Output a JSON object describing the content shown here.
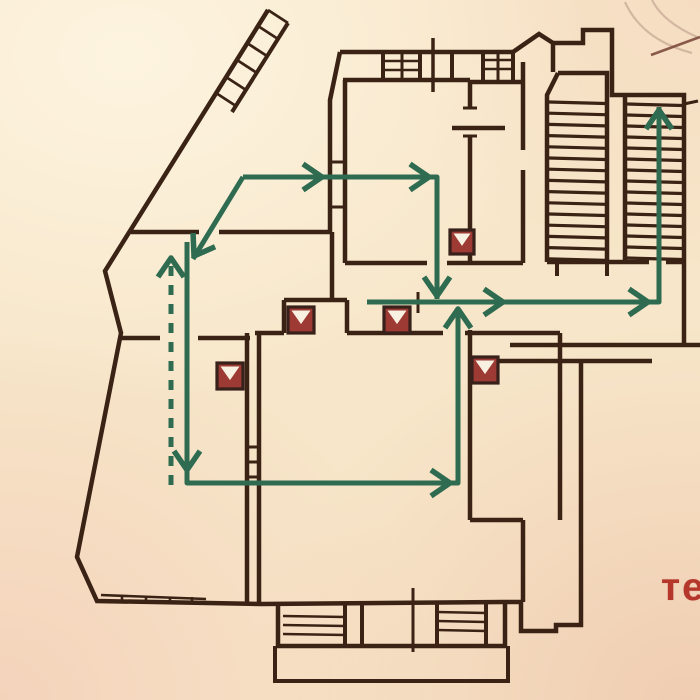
{
  "meta": {
    "description": "Photograph of a building evacuation floor plan with green escape-route arrows and red equipment markers",
    "background_paper": "#f7e6c9"
  },
  "palette": {
    "wall": "#3a2315",
    "route_green": "#2e6b50",
    "marker_fill": "#9d3a33",
    "marker_border": "#37211a",
    "marker_triangle": "#f8f0e0",
    "text_red": "#b5372c",
    "stamp": "#a98a76",
    "stamp_line": "#7d4a3c"
  },
  "annotations": {
    "partial_text": "те"
  },
  "building": {
    "walls": [
      {
        "d": "M268,10 L105,271 L121,333 L77,557 L97,601 L262,604 L503,602 L521,602 L521,631 L556,631 L556,625 L581,625 L581,362"
      },
      {
        "d": "M481,361 L652,361"
      },
      {
        "d": "M510,345 L700,345"
      },
      {
        "d": "M684,345 L684,262"
      },
      {
        "d": "M547,262 L649,262 M666,262 L684,262"
      },
      {
        "d": "M558,73 L607,73 L607,262 M558,73 L547,95 L547,262"
      },
      {
        "d": "M625,95 L684,95 L684,262 M625,95 L625,262"
      },
      {
        "d": "M553,72 L553,43 L583,43 L583,30 L612,30 L612,95 L625,95"
      },
      {
        "d": "M684,104 L698,101",
        "w": 3
      },
      {
        "d": "M340,52 L513,52 L539,34 L553,43"
      },
      {
        "d": "M288,23 L232,112",
        "w": 4
      },
      {
        "d": "M268,10 L288,23 M258,26 L278,39 M247,43 L267,56 M237,60 L257,73 M226,77 L246,90 M216,93 L236,106",
        "w": 2.8
      },
      {
        "d": "M343,80 L470,80"
      },
      {
        "d": "M470,80 L470,108 M470,136 L470,263"
      },
      {
        "d": "M452,128 L505,128"
      },
      {
        "d": "M463,108 L477,108 M463,136 L477,136",
        "w": 3
      },
      {
        "d": "M340,52 L330,100 L330,232"
      },
      {
        "d": "M345,80 L345,232"
      },
      {
        "d": "M330,162 L345,162 M330,207 L345,207",
        "w": 3
      },
      {
        "d": "M131,232 L199,232 M219,232 L330,232"
      },
      {
        "d": "M523,62 L523,150 M523,170 L523,263"
      },
      {
        "d": "M470,82 L523,82"
      },
      {
        "d": "M332,232 L332,300"
      },
      {
        "d": "M284,300 L347,300 M284,300 L284,333 M347,300 L347,333"
      },
      {
        "d": "M255,333 L284,333 M347,333 L443,333 M465,333 L560,333"
      },
      {
        "d": "M345,232 L345,263 M345,263 L427,263 M447,263 L523,263"
      },
      {
        "d": "M121,338 L160,338 M198,338 L250,338"
      },
      {
        "d": "M247,333 L247,603 M259,333 L259,603"
      },
      {
        "d": "M247,447 L259,447 M247,462 L259,462 M247,477 L259,477",
        "w": 3
      },
      {
        "d": "M470,330 L470,520 M560,333 L560,520 M470,520 L523,520 M523,520 L523,602"
      },
      {
        "d": "M418,292 L418,313",
        "w": 3
      },
      {
        "d": "M433,38 L433,92",
        "w": 3.5
      },
      {
        "d": "M413,588 L413,652",
        "w": 3
      },
      {
        "d": "M278,604 L278,646 L505,646 L505,603"
      },
      {
        "d": "M345,604 L345,645 M362,604 L362,645 M437,604 L437,645 M486,604 L486,645",
        "w": 4
      },
      {
        "d": "M283,616 L345,617 M283,625 L345,626 M283,634 L345,635 M437,612 L486,613 M437,621 L486,622 M437,630 L486,631",
        "w": 2.6
      },
      {
        "d": "M275,646 L275,681 L508,681 L508,646",
        "w": 4
      },
      {
        "d": "M101,595 L206,599",
        "w": 2.6
      },
      {
        "d": "M122,595 L122,602 M146,596 L146,603 M170,597 L170,603 M192,597 L192,604",
        "w": 2.6
      },
      {
        "d": "M383,52 L383,80 M420,52 L420,80 M452,52 L452,80 M483,52 L483,80 M513,52 L513,80",
        "w": 4
      },
      {
        "d": "M402,52 L402,80 M498,52 L498,80",
        "w": 3
      },
      {
        "d": "M383,61 L420,61 M383,70 L420,70 M483,60 L513,60 M483,69 L513,69",
        "w": 2.6
      },
      {
        "d": "M557,262 L557,276 M607,262 L607,276",
        "w": 4
      }
    ],
    "stairs": [
      {
        "name": "staircase-mid",
        "x1": 549,
        "x2": 605,
        "y0": 102,
        "count": 15,
        "dy": 11.2,
        "w": 3.2
      },
      {
        "name": "staircase-right",
        "x1": 627,
        "x2": 682,
        "y0": 104,
        "count": 15,
        "dy": 11,
        "w": 3.2
      }
    ]
  },
  "routes": {
    "width": 5,
    "lines": [
      {
        "name": "route-upper-corridor",
        "points": [
          [
            243,
            177
          ],
          [
            437,
            177
          ],
          [
            437,
            299
          ]
        ],
        "dashed": false
      },
      {
        "name": "route-upper-branch-diagonal",
        "points": [
          [
            243,
            177
          ],
          [
            193,
            259
          ]
        ],
        "dashed": false
      },
      {
        "name": "route-left-hall-to-lower-room",
        "points": [
          [
            187,
            242
          ],
          [
            187,
            483
          ],
          [
            458,
            483
          ],
          [
            458,
            308
          ]
        ],
        "dashed": false
      },
      {
        "name": "route-central-corridor-to-right-stairs",
        "points": [
          [
            367,
            302
          ],
          [
            659,
            302
          ],
          [
            659,
            107
          ]
        ],
        "dashed": false
      },
      {
        "name": "route-from-lower-floor-dashed",
        "points": [
          [
            171,
            266
          ],
          [
            171,
            493
          ]
        ],
        "dashed": true
      }
    ],
    "arrows": [
      {
        "x": 322,
        "y": 177,
        "angle": 0
      },
      {
        "x": 429,
        "y": 177,
        "angle": 0
      },
      {
        "x": 437,
        "y": 296,
        "angle": 90
      },
      {
        "x": 194,
        "y": 256,
        "angle": 122
      },
      {
        "x": 187,
        "y": 470,
        "angle": 90
      },
      {
        "x": 450,
        "y": 483,
        "angle": 0
      },
      {
        "x": 458,
        "y": 309,
        "angle": -90
      },
      {
        "x": 503,
        "y": 302,
        "angle": 0
      },
      {
        "x": 648,
        "y": 302,
        "angle": 0
      },
      {
        "x": 659,
        "y": 110,
        "angle": -90
      },
      {
        "x": 171,
        "y": 258,
        "angle": -90
      }
    ]
  },
  "markers": {
    "symbol": "white downward triangle in red square",
    "items": [
      {
        "x": 288,
        "y": 307,
        "s": 26
      },
      {
        "x": 384,
        "y": 307,
        "s": 26
      },
      {
        "x": 450,
        "y": 230,
        "s": 24
      },
      {
        "x": 217,
        "y": 363,
        "s": 26
      },
      {
        "x": 472,
        "y": 357,
        "s": 26
      }
    ]
  },
  "stamp": {
    "arcs": [
      "M625,2 Q642,40 692,53",
      "M652,0 Q663,22 697,37"
    ],
    "line": "M651,55 L700,37"
  }
}
